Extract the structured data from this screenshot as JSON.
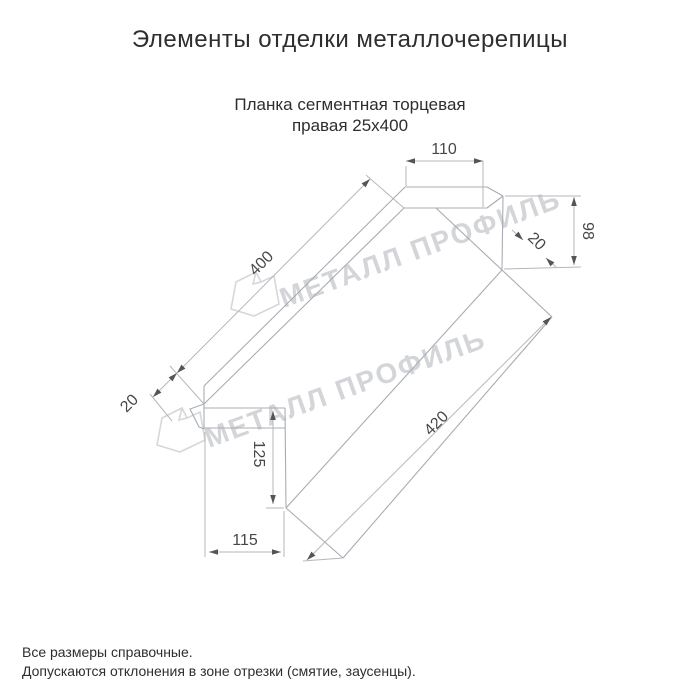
{
  "title": "Элементы отделки металлочерепицы",
  "subtitle": {
    "line1": "Планка сегментная торцевая",
    "line2": "правая 25x400"
  },
  "watermark": {
    "text": "МЕТАЛЛ ПРОФИЛЬ"
  },
  "dimensions": {
    "top_flange_width": "110",
    "right_end_height": "98",
    "right_hem": "20",
    "top_edge_length": "400",
    "left_hem": "20",
    "bottom_edge_length": "420",
    "left_end_height": "125",
    "bottom_flange_width": "115"
  },
  "footer": {
    "line1": "Все размеры справочные.",
    "line2": "Допускаются отклонения в зоне отрезки (смятие, заусенцы)."
  }
}
